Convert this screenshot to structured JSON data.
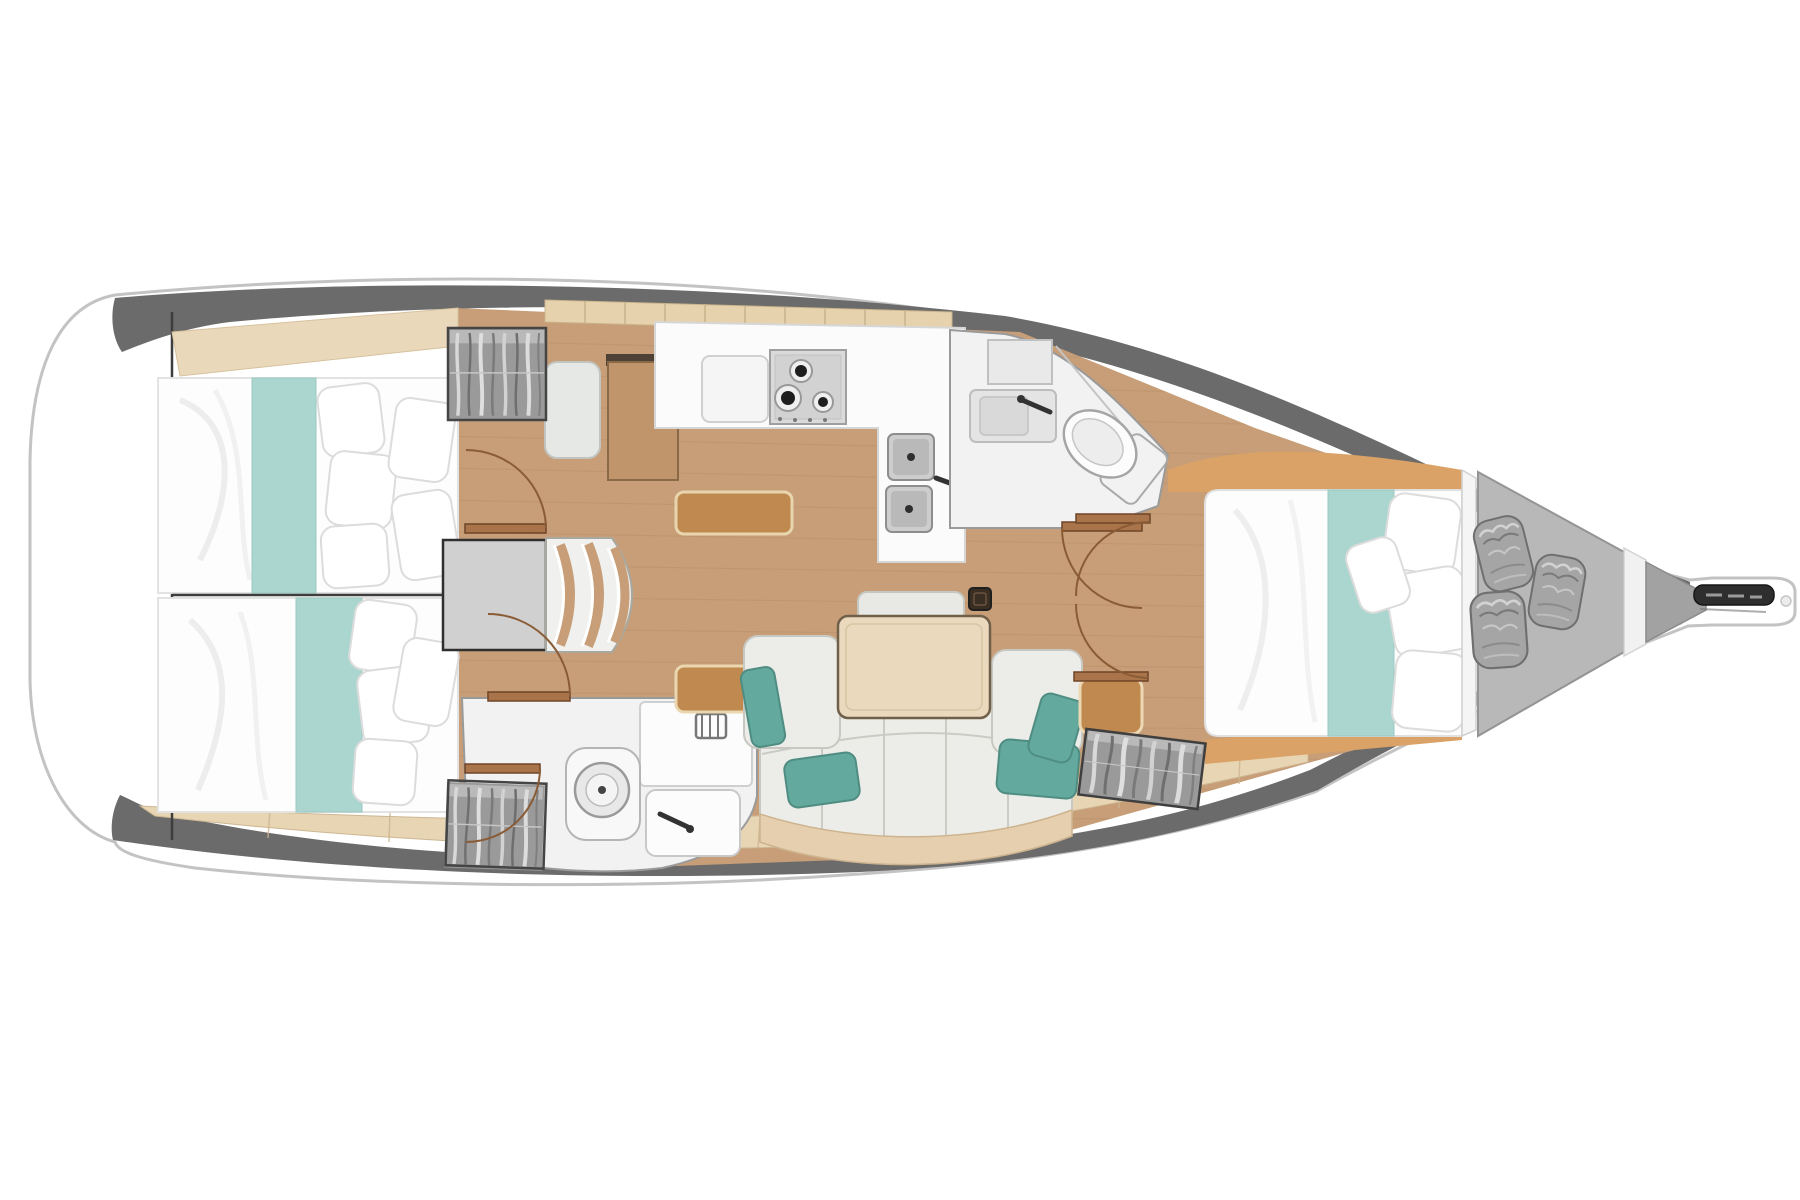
{
  "meta": {
    "title": "Sailboat interior layout floor plan (top view, bow to the right)",
    "diagram_type": "yacht-floor-plan",
    "orientation": "bow-right"
  },
  "colors": {
    "page_bg": "#ffffff",
    "hull_fill": "#ffffff",
    "hull_stroke": "#c3c3c3",
    "deck_band": "#6b6b6b",
    "floor_wood": "#c79e77",
    "floor_plank_line": "#b28a64",
    "fwd_wedge_wood": "#daa266",
    "side_shelf_wood": "#e8d5b4",
    "headboard_wood": "#e9d8ba",
    "cubby_wood": "#e7d2ae",
    "counter_white": "#fbfbfb",
    "appliance_gray": "#dadada",
    "sink_gray": "#cdcdcd",
    "bed_white": "#fdfdfd",
    "runner_teal": "#abd6d0",
    "pillow_white": "#ffffff",
    "sofa_fabric": "#ecece8",
    "sofa_base": "#e6cfae",
    "cushion_teal": "#64a99e",
    "table_wood": "#ead9bc",
    "locker_amber": "#bf8950",
    "nav_desk_wood": "#c1956b",
    "wardrobe_gray": "#9a9a9a",
    "head_floor": "#f2f2f2",
    "fixture_white": "#fcfcfc",
    "door_arc": "#8a5c36",
    "engine_gray": "#d0d0d0",
    "stairs_white": "#f0f0ee",
    "sail_locker_gray": "#b8b8b8",
    "sail_bag_gray": "#a5a5a5",
    "anchor_dark": "#2e2e2e",
    "divider_line": "#3d3d3d"
  },
  "rooms": [
    {
      "id": "transom",
      "name": "Stern transom / swim platform"
    },
    {
      "id": "aft-cabin-port",
      "name": "Aft double cabin (port)"
    },
    {
      "id": "aft-cabin-starboard",
      "name": "Aft double cabin (starboard)"
    },
    {
      "id": "companionway",
      "name": "Companionway with steps and engine box"
    },
    {
      "id": "nav-station",
      "name": "Navigation station"
    },
    {
      "id": "galley",
      "name": "Galley with stove and double sink"
    },
    {
      "id": "aft-head",
      "name": "Aft head with shower, toilet and sink"
    },
    {
      "id": "salon",
      "name": "Salon with U-sofa, dining table and bench"
    },
    {
      "id": "forward-head",
      "name": "Forward head with vanity and toilet"
    },
    {
      "id": "forward-cabin",
      "name": "Forward double cabin"
    },
    {
      "id": "sail-locker",
      "name": "Bow sail locker with three sail bags"
    },
    {
      "id": "bow",
      "name": "Bow platform with anchor roller"
    }
  ],
  "fixtures": [
    "double-berth-aft-port",
    "double-berth-aft-starboard",
    "double-berth-forward",
    "teal-bed-runner",
    "bed-pillows",
    "hanging-locker-aft",
    "hanging-locker-head",
    "hanging-locker-forward",
    "companionway-steps",
    "engine-box",
    "nav-seat",
    "nav-desk",
    "stove-3-burner",
    "galley-double-sink",
    "galley-cubby-shelf",
    "dining-table",
    "salon-bench",
    "u-shaped-sofa",
    "teal-throw-pillows",
    "shower-pan",
    "toilet-aft",
    "toilet-forward",
    "vanity-sink",
    "wash-basin",
    "storage-locker-amber",
    "sail-bags",
    "anchor-roller",
    "cabin-doors"
  ]
}
